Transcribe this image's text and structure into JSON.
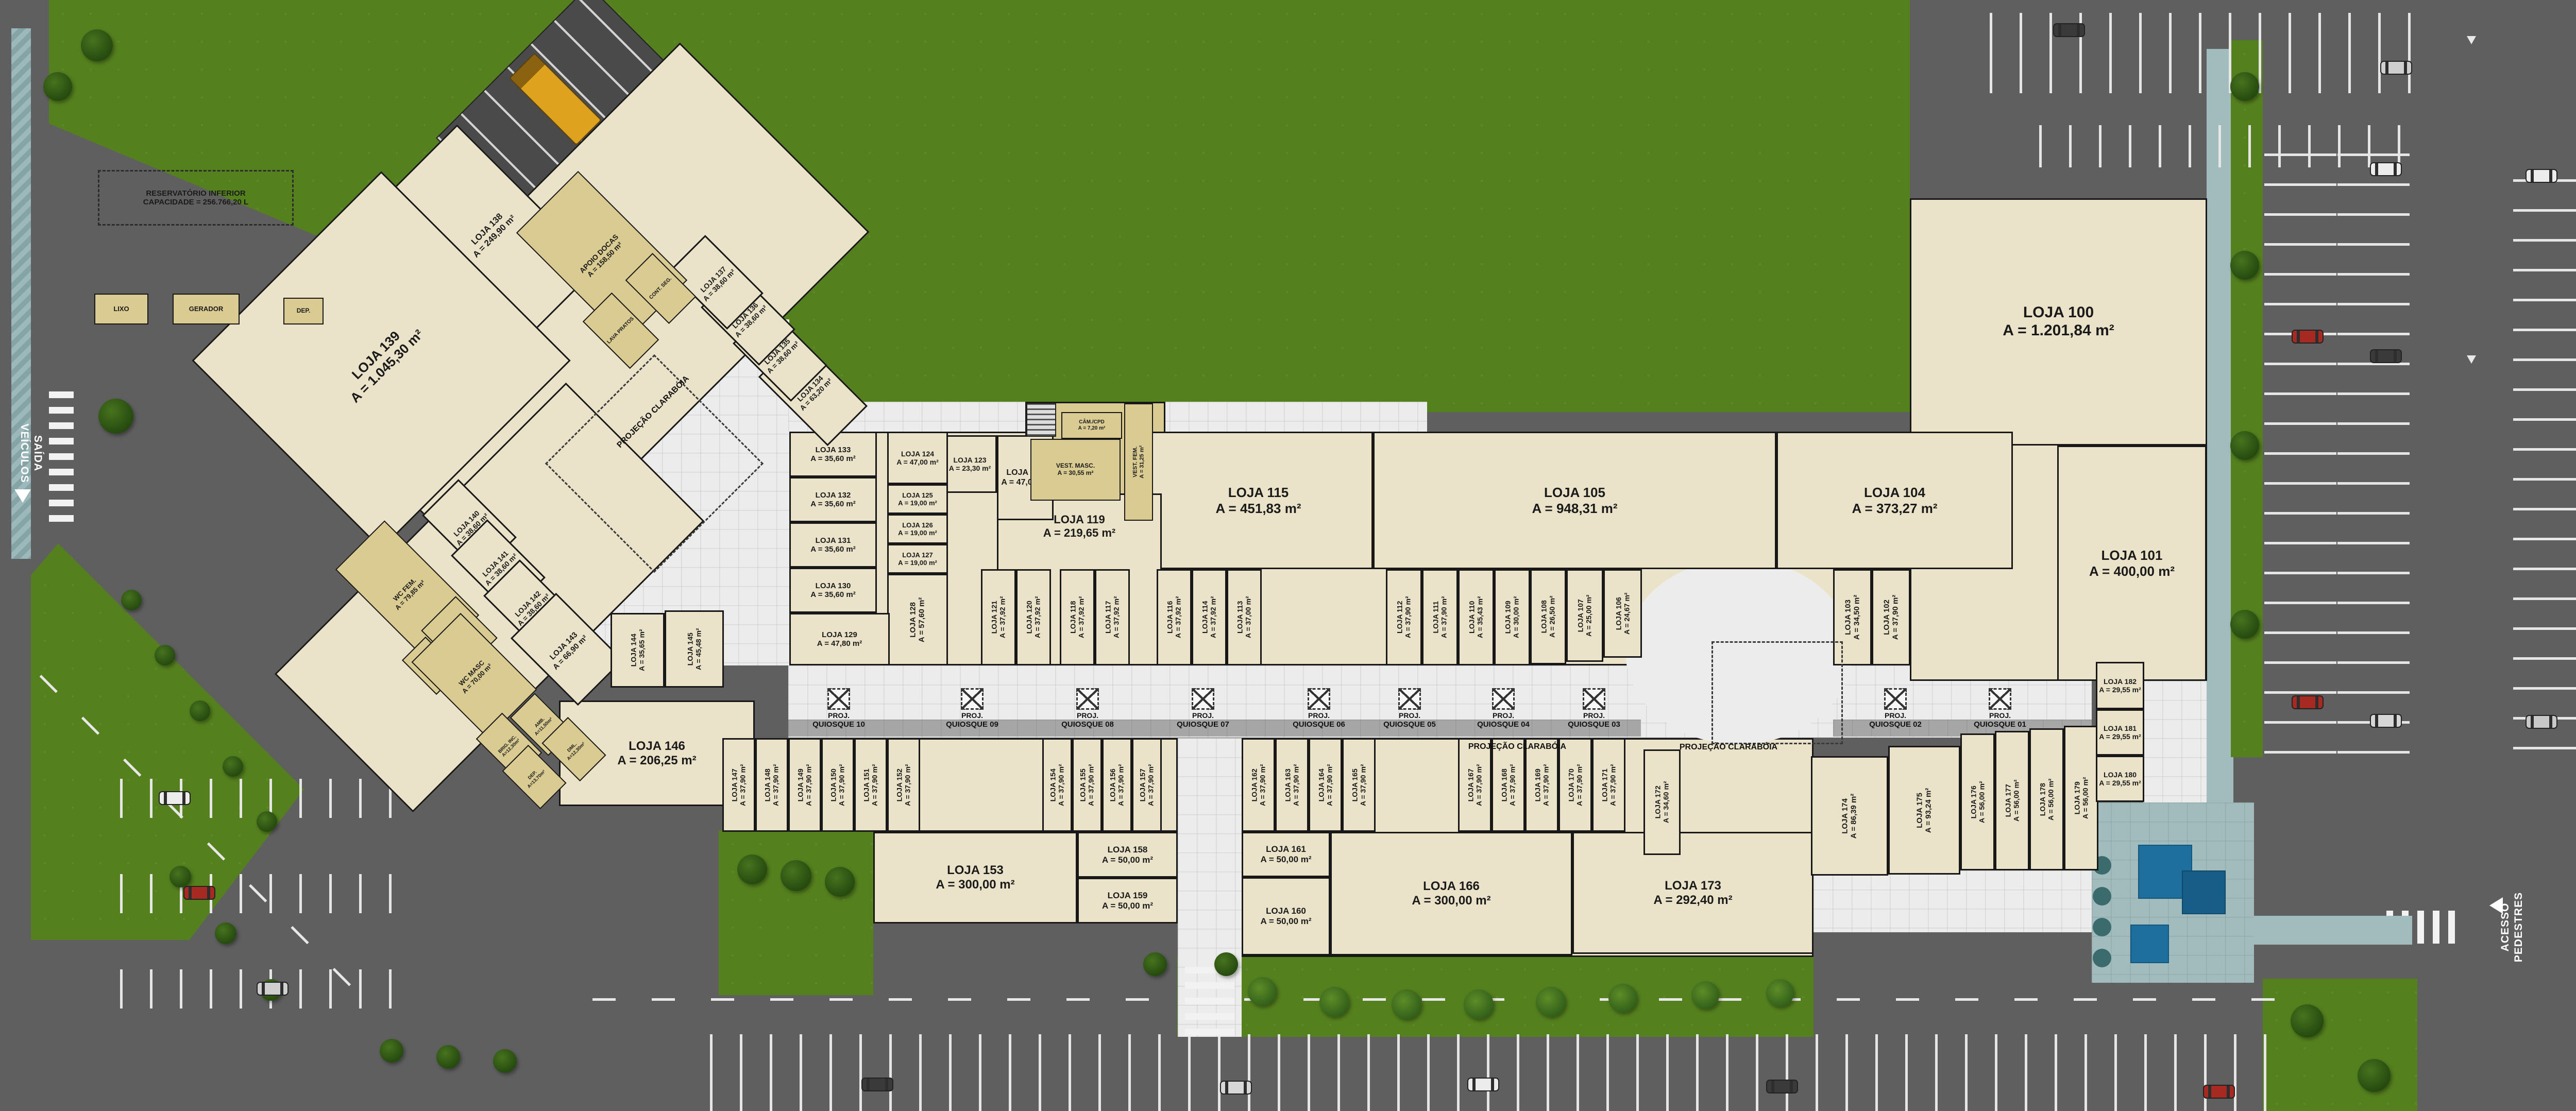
{
  "palette": {
    "beige": "#eae3c9",
    "wall": "#181818",
    "grass": "#55801e",
    "asphalt": "#5f5f5f",
    "walkway": "#ececec",
    "walk_gray": "#a6a6a6",
    "service": "#d9cb92",
    "teal": "#a2bcbe",
    "pool_blue": "#1e6e9e",
    "truck_yellow": "#dfa21f"
  },
  "plan": {
    "road_labels": {
      "saida_l1": "SAÍDA",
      "saida_l2": "VEÍCULOS",
      "acesso_l1": "ACESSO",
      "acesso_l2": "PEDESTRES"
    },
    "reservoir": {
      "l1": "RESERVATÓRIO INFERIOR",
      "l2": "CAPACIDADE = 256.766,20 L"
    },
    "skylight": "PROJEÇÃO CLARABÓIA",
    "kiosk_prefix": "PROJ.",
    "kiosks": [
      "QUIOSQUE 10",
      "QUIOSQUE 09",
      "QUIOSQUE 08",
      "QUIOSQUE 07",
      "QUIOSQUE 06",
      "QUIOSQUE 05",
      "QUIOSQUE 04",
      "QUIOSQUE 03",
      "QUIOSQUE 02",
      "QUIOSQUE 01"
    ],
    "services": [
      {
        "id": "lixo",
        "label": "LIXO"
      },
      {
        "id": "gerador",
        "label": "GERADOR"
      },
      {
        "id": "dep_top",
        "label": "DEP."
      },
      {
        "id": "apoio",
        "label": "APOIO DOCAS",
        "area": "A = 158,50 m²"
      },
      {
        "id": "cont_seg",
        "label": "CONT. SEG."
      },
      {
        "id": "lava",
        "label": "LAVA PRATOS"
      },
      {
        "id": "wc_fem",
        "label": "WC FEM.",
        "area": "A = 79,85 m²"
      },
      {
        "id": "sala_amam",
        "label": "SALA AMAM",
        "area": "A = 13,10 m²"
      },
      {
        "id": "frald",
        "label": "FRAUD."
      },
      {
        "id": "wc_masc",
        "label": "WC MASC",
        "area": "A = 70,00 m²"
      },
      {
        "id": "amb",
        "label": "AMB.",
        "area": "A=11,50m²"
      },
      {
        "id": "brig",
        "label": "BRIG. INC.",
        "area": "A=12,30m²"
      },
      {
        "id": "dml",
        "label": "DML.",
        "area": "A=12,30m²"
      },
      {
        "id": "dep2",
        "label": "DEP.",
        "area": "A=13,70m²"
      },
      {
        "id": "cam_cpd",
        "label": "CÂM./CPD",
        "area": "A = 7,20 m²"
      },
      {
        "id": "vest_masc",
        "label": "VEST. MASC.",
        "area": "A = 30,55 m²"
      },
      {
        "id": "vest_fem",
        "label": "VEST. FEM.",
        "area": "A = 31,25 m²"
      }
    ],
    "stores": [
      {
        "id": "100",
        "name": "LOJA 100",
        "area": "A = 1.201,84 m²"
      },
      {
        "id": "101",
        "name": "LOJA 101",
        "area": "A = 400,00 m²"
      },
      {
        "id": "102",
        "name": "LOJA 102",
        "area": "A = 37,90 m²"
      },
      {
        "id": "103",
        "name": "LOJA 103",
        "area": "A = 34,50 m²"
      },
      {
        "id": "104",
        "name": "LOJA 104",
        "area": "A = 373,27 m²"
      },
      {
        "id": "105",
        "name": "LOJA 105",
        "area": "A = 948,31 m²"
      },
      {
        "id": "106",
        "name": "LOJA 106",
        "area": "A = 24,67 m²"
      },
      {
        "id": "107",
        "name": "LOJA 107",
        "area": "A = 25,00 m²"
      },
      {
        "id": "108",
        "name": "LOJA 108",
        "area": "A = 26,50 m²"
      },
      {
        "id": "109",
        "name": "LOJA 109",
        "area": "A = 30,00 m²"
      },
      {
        "id": "110",
        "name": "LOJA 110",
        "area": "A = 35,43 m²"
      },
      {
        "id": "111",
        "name": "LOJA 111",
        "area": "A = 37,90 m²"
      },
      {
        "id": "112",
        "name": "LOJA 112",
        "area": "A = 37,90 m²"
      },
      {
        "id": "113",
        "name": "LOJA 113",
        "area": "A = 37,00 m²"
      },
      {
        "id": "114",
        "name": "LOJA 114",
        "area": "A = 37,92 m²"
      },
      {
        "id": "115",
        "name": "LOJA 115",
        "area": "A = 451,83 m²"
      },
      {
        "id": "116",
        "name": "LOJA 116",
        "area": "A = 37,92 m²"
      },
      {
        "id": "117",
        "name": "LOJA 117",
        "area": "A = 37,92 m²"
      },
      {
        "id": "118",
        "name": "LOJA 118",
        "area": "A = 37,92 m²"
      },
      {
        "id": "119",
        "name": "LOJA 119",
        "area": "A = 219,65 m²"
      },
      {
        "id": "120",
        "name": "LOJA 120",
        "area": "A = 37,92 m²"
      },
      {
        "id": "121",
        "name": "LOJA 121",
        "area": "A = 37,92 m²"
      },
      {
        "id": "122",
        "name": "LOJA 122",
        "area": "A = 47,00 m²"
      },
      {
        "id": "123",
        "name": "LOJA 123",
        "area": "A = 23,30 m²"
      },
      {
        "id": "124",
        "name": "LOJA 124",
        "area": "A = 47,00 m²"
      },
      {
        "id": "125",
        "name": "LOJA 125",
        "area": "A = 19,00 m²"
      },
      {
        "id": "126",
        "name": "LOJA 126",
        "area": "A = 19,00 m²"
      },
      {
        "id": "127",
        "name": "LOJA 127",
        "area": "A = 19,00 m²"
      },
      {
        "id": "128",
        "name": "LOJA 128",
        "area": "A = 57,60 m²"
      },
      {
        "id": "129",
        "name": "LOJA 129",
        "area": "A = 47,80 m²"
      },
      {
        "id": "130",
        "name": "LOJA 130",
        "area": "A = 35,60 m²"
      },
      {
        "id": "131",
        "name": "LOJA 131",
        "area": "A = 35,60 m²"
      },
      {
        "id": "132",
        "name": "LOJA 132",
        "area": "A = 35,60 m²"
      },
      {
        "id": "133",
        "name": "LOJA 133",
        "area": "A = 35,60 m²"
      },
      {
        "id": "134",
        "name": "LOJA 134",
        "area": "A = 63,20 m²"
      },
      {
        "id": "135",
        "name": "LOJA 135",
        "area": "A = 38,60 m²"
      },
      {
        "id": "136",
        "name": "LOJA 136",
        "area": "A = 38,60 m²"
      },
      {
        "id": "137",
        "name": "LOJA 137",
        "area": "A = 38,60 m²"
      },
      {
        "id": "138",
        "name": "LOJA 138",
        "area": "A = 249,90 m²"
      },
      {
        "id": "139",
        "name": "LOJA 139",
        "area": "A = 1.045,30 m²"
      },
      {
        "id": "140",
        "name": "LOJA 140",
        "area": "A = 38,60 m²"
      },
      {
        "id": "141",
        "name": "LOJA 141",
        "area": "A = 38,60 m²"
      },
      {
        "id": "142",
        "name": "LOJA 142",
        "area": "A = 38,60 m²"
      },
      {
        "id": "143",
        "name": "LOJA 143",
        "area": "A = 66,90 m²"
      },
      {
        "id": "144",
        "name": "LOJA 144",
        "area": "A = 35,65 m²"
      },
      {
        "id": "145",
        "name": "LOJA 145",
        "area": "A = 45,48 m²"
      },
      {
        "id": "146",
        "name": "LOJA 146",
        "area": "A = 206,25 m²"
      },
      {
        "id": "147",
        "name": "LOJA 147",
        "area": "A = 37,90 m²"
      },
      {
        "id": "148",
        "name": "LOJA 148",
        "area": "A = 37,90 m²"
      },
      {
        "id": "149",
        "name": "LOJA 149",
        "area": "A = 37,90 m²"
      },
      {
        "id": "150",
        "name": "LOJA 150",
        "area": "A = 37,90 m²"
      },
      {
        "id": "151",
        "name": "LOJA 151",
        "area": "A = 37,90 m²"
      },
      {
        "id": "152",
        "name": "LOJA 152",
        "area": "A = 37,90 m²"
      },
      {
        "id": "153",
        "name": "LOJA 153",
        "area": "A = 300,00 m²"
      },
      {
        "id": "154",
        "name": "LOJA 154",
        "area": "A = 37,90 m²"
      },
      {
        "id": "155",
        "name": "LOJA 155",
        "area": "A = 37,90 m²"
      },
      {
        "id": "156",
        "name": "LOJA 156",
        "area": "A = 37,90 m²"
      },
      {
        "id": "157",
        "name": "LOJA 157",
        "area": "A = 37,90 m²"
      },
      {
        "id": "158",
        "name": "LOJA 158",
        "area": "A = 50,00 m²"
      },
      {
        "id": "159",
        "name": "LOJA 159",
        "area": "A = 50,00 m²"
      },
      {
        "id": "160",
        "name": "LOJA 160",
        "area": "A = 50,00 m²"
      },
      {
        "id": "161",
        "name": "LOJA 161",
        "area": "A = 50,00 m²"
      },
      {
        "id": "162",
        "name": "LOJA 162",
        "area": "A = 37,90 m²"
      },
      {
        "id": "163",
        "name": "LOJA 163",
        "area": "A = 37,90 m²"
      },
      {
        "id": "164",
        "name": "LOJA 164",
        "area": "A = 37,90 m²"
      },
      {
        "id": "165",
        "name": "LOJA 165",
        "area": "A = 37,90 m²"
      },
      {
        "id": "166",
        "name": "LOJA 166",
        "area": "A = 300,00 m²"
      },
      {
        "id": "167",
        "name": "LOJA 167",
        "area": "A = 37,90 m²"
      },
      {
        "id": "168",
        "name": "LOJA 168",
        "area": "A = 37,90 m²"
      },
      {
        "id": "169",
        "name": "LOJA 169",
        "area": "A = 37,90 m²"
      },
      {
        "id": "170",
        "name": "LOJA 170",
        "area": "A = 37,90 m²"
      },
      {
        "id": "171",
        "name": "LOJA 171",
        "area": "A = 37,90 m²"
      },
      {
        "id": "172",
        "name": "LOJA 172",
        "area": "A = 34,60 m²"
      },
      {
        "id": "173",
        "name": "LOJA 173",
        "area": "A = 292,40 m²"
      },
      {
        "id": "174",
        "name": "LOJA 174",
        "area": "A = 86,39 m²"
      },
      {
        "id": "175",
        "name": "LOJA 175",
        "area": "A = 93,24 m²"
      },
      {
        "id": "176",
        "name": "LOJA 176",
        "area": "A = 56,00 m²"
      },
      {
        "id": "177",
        "name": "LOJA 177",
        "area": "A = 56,00 m²"
      },
      {
        "id": "178",
        "name": "LOJA 178",
        "area": "A = 56,00 m²"
      },
      {
        "id": "179",
        "name": "LOJA 179",
        "area": "A = 56,00 m²"
      },
      {
        "id": "180",
        "name": "LOJA 180",
        "area": "A = 29,55 m²"
      },
      {
        "id": "181",
        "name": "LOJA 181",
        "area": "A = 29,55 m²"
      },
      {
        "id": "182",
        "name": "LOJA 182",
        "area": "A = 29,55 m²"
      }
    ]
  }
}
